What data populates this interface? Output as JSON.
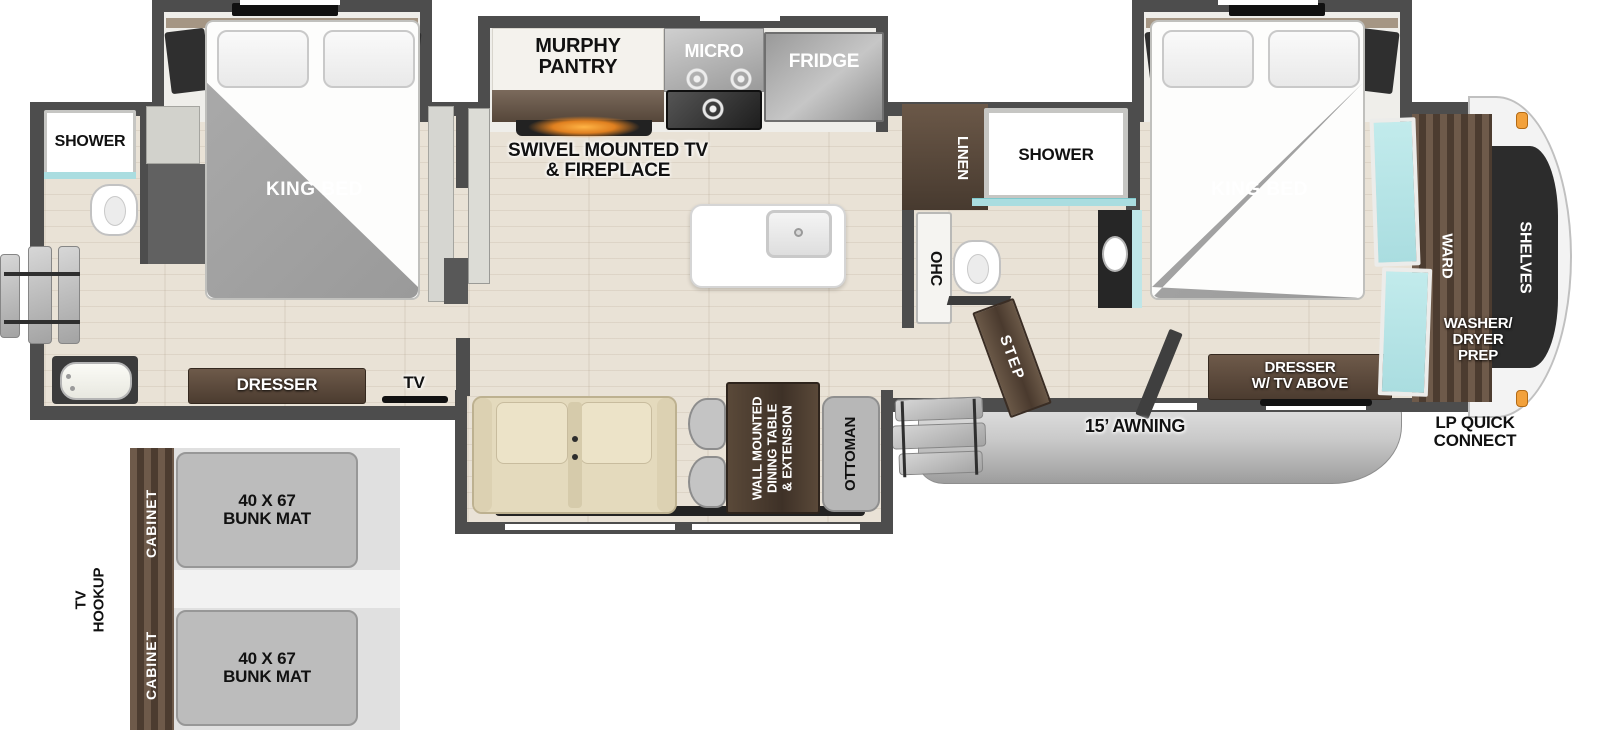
{
  "title": "RV fifth-wheel floor plan",
  "colors": {
    "wall": "#4d4d4d",
    "floor": "#e9e2d6",
    "slide_interior": "#efeeea",
    "wood_mid": "#6e5a4a",
    "wood_dark": "#4c3c30",
    "bed_blanket": "#9a9a9a",
    "teal": "#aadde0",
    "orange_light": "#f2a13c",
    "fireplace_glow": "#ffb445",
    "sofa": "#e4dabd",
    "gray_furn": "#b7b7b7",
    "awning_gray": "#c9c9c9",
    "cap_white": "#f3f3f3",
    "shelves_black": "#2c2c2c"
  },
  "labels": {
    "rear_king_bed": "KING BED",
    "front_king_bed": "KING BED",
    "rear_shower": "SHOWER",
    "mid_shower": "SHOWER",
    "murphy_pantry": [
      "MURPHY",
      "PANTRY"
    ],
    "micro": "MICRO",
    "fridge": "FRIDGE",
    "swivel": [
      "SWIVEL MOUNTED TV",
      "& FIREPLACE"
    ],
    "linen": "LINEN",
    "ohc": "OHC",
    "step": "STEP",
    "rear_dresser": "DRESSER",
    "rear_tv": "TV",
    "front_dresser": [
      "DRESSER",
      "W/ TV ABOVE"
    ],
    "ward": "WARD",
    "shelves": "SHELVES",
    "washer_dryer_prep": [
      "WASHER/",
      "DRYER",
      "PREP"
    ],
    "lp_quick_connect": [
      "LP QUICK",
      "CONNECT"
    ],
    "awning": "15’ AWNING",
    "dining_table": [
      "WALL MOUNTED",
      "DINING TABLE",
      "& EXTENSION"
    ],
    "ottoman": "OTTOMAN",
    "bunk_mat_top": [
      "40 X 67",
      "BUNK MAT"
    ],
    "bunk_mat_bottom": [
      "40 X 67",
      "BUNK MAT"
    ],
    "cabinet_top": "CABINET",
    "cabinet_bottom": "CABINET",
    "tv_hookup": [
      "TV",
      "HOOKUP"
    ]
  }
}
